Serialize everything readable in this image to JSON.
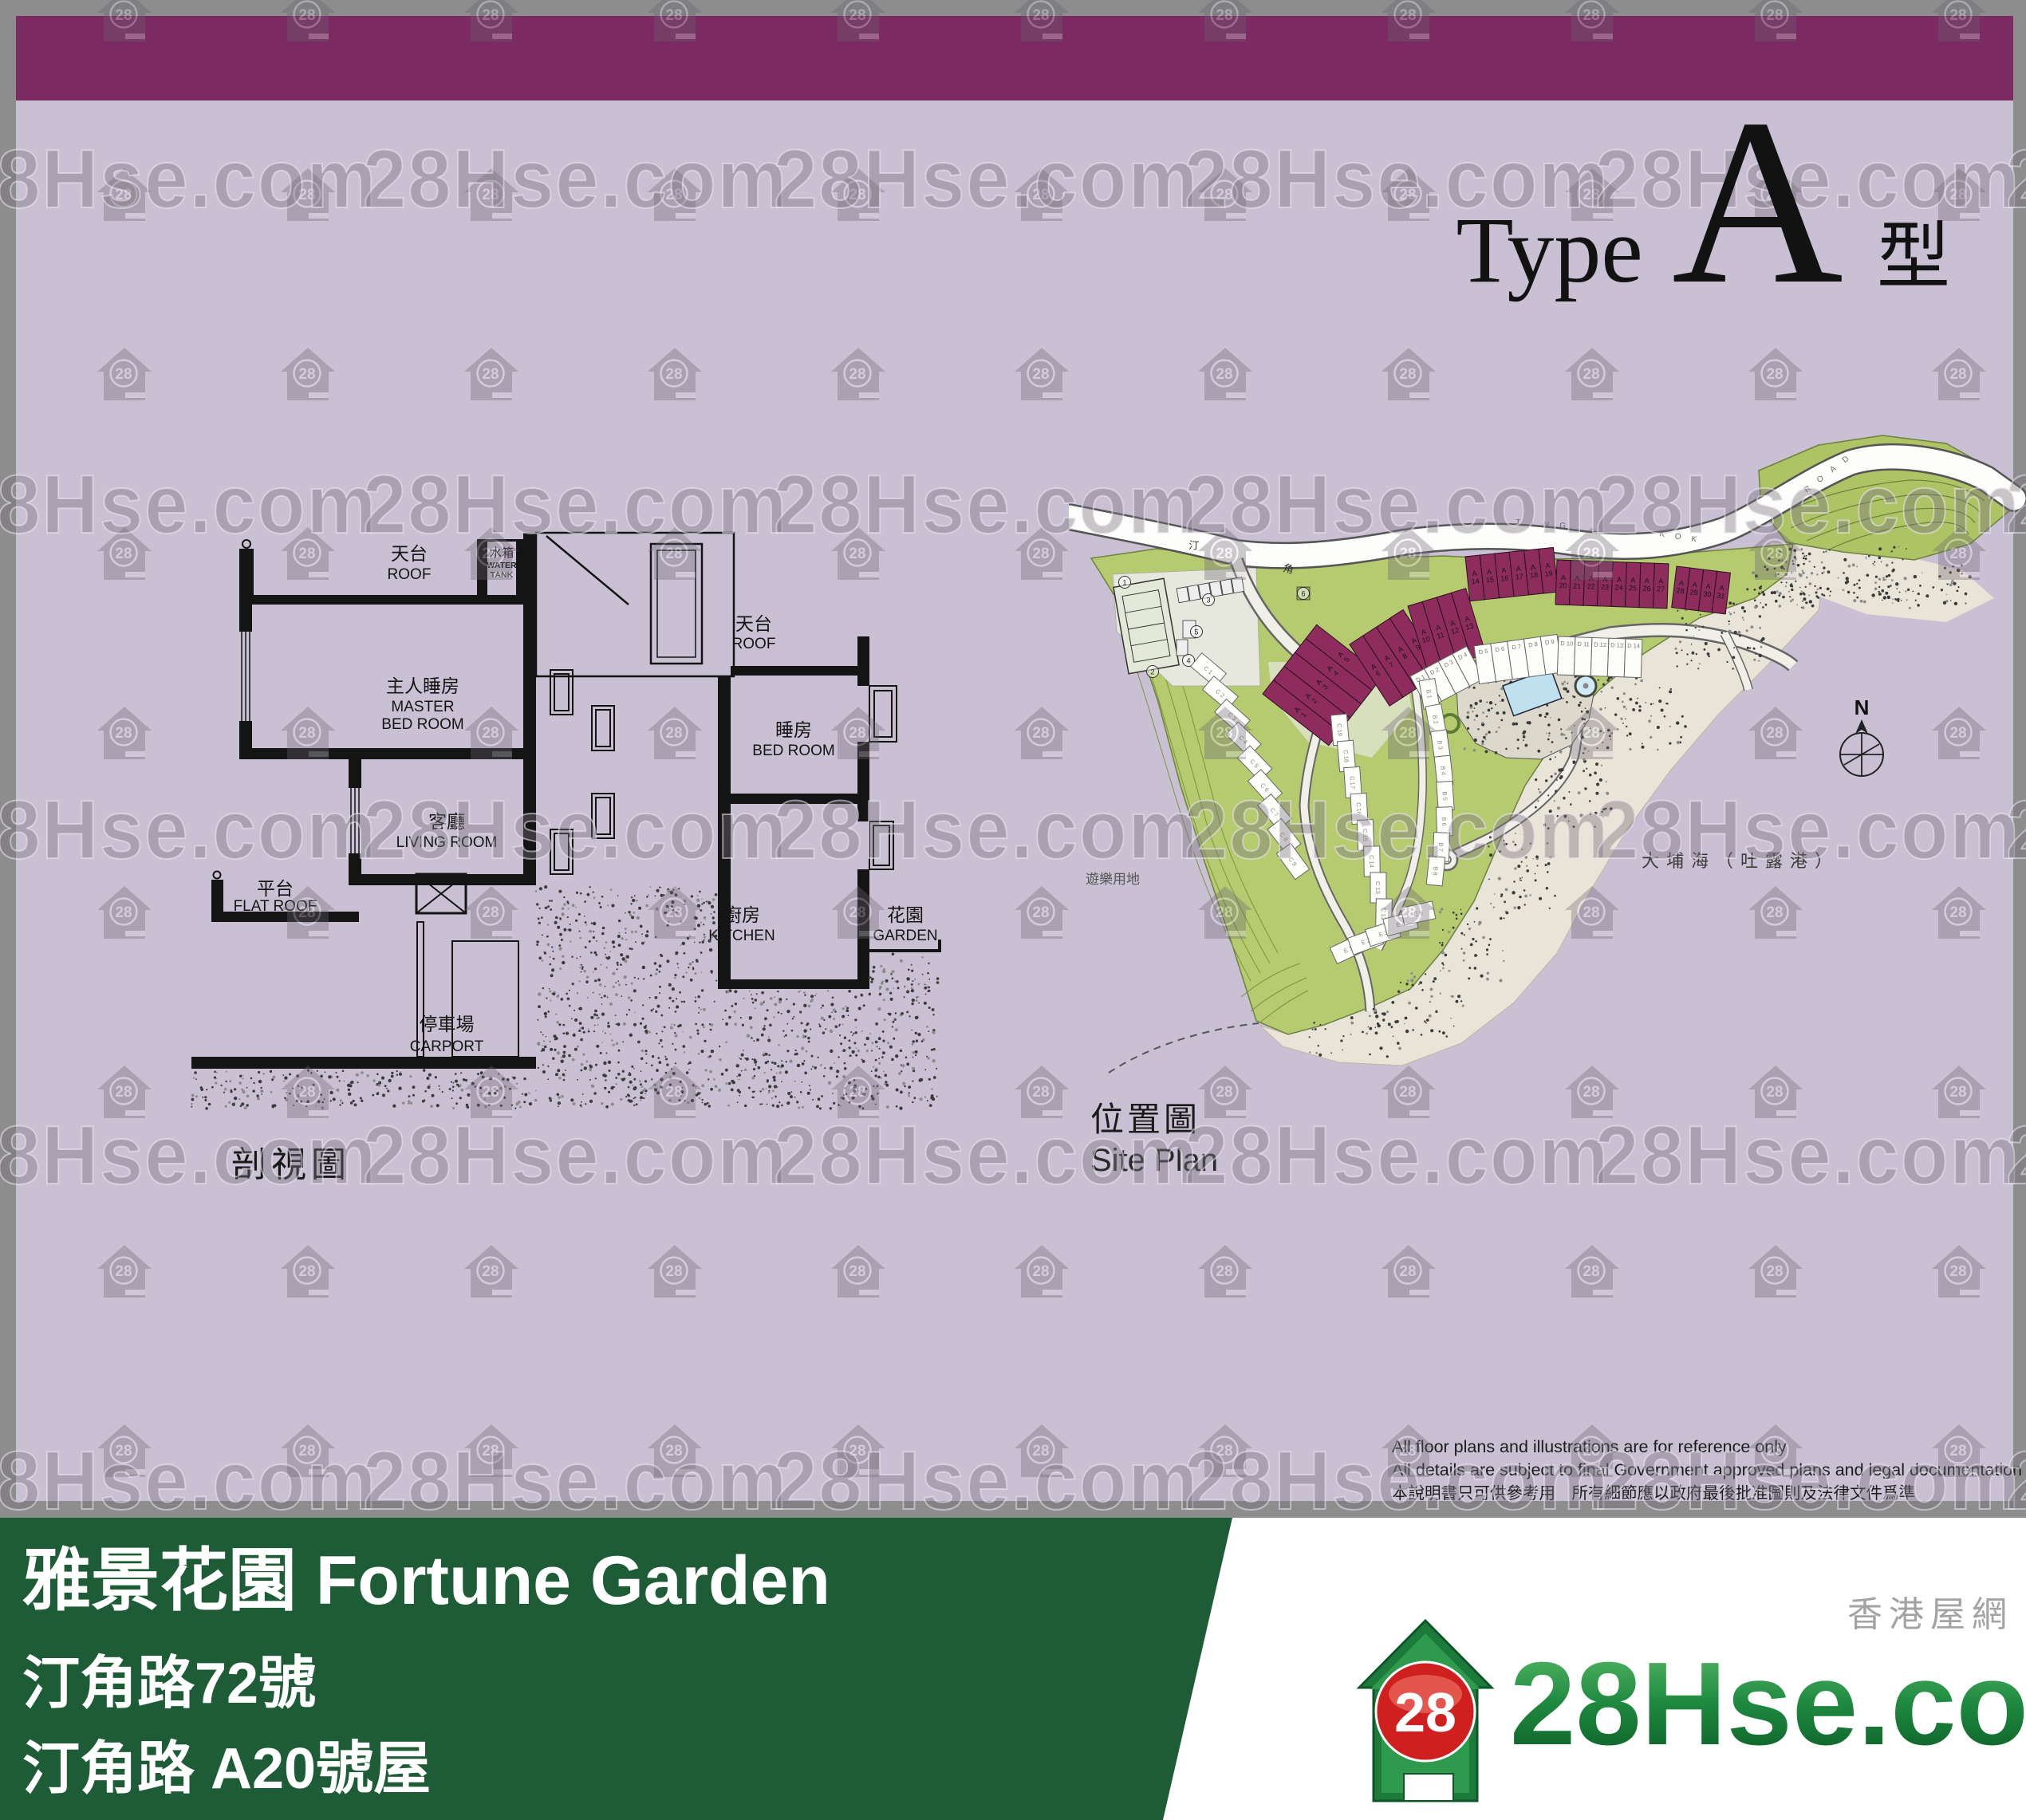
{
  "title": {
    "prefix": "Type",
    "letter": "A",
    "suffix": "型"
  },
  "watermark": {
    "text": "28Hse.com",
    "badge": "28"
  },
  "section": {
    "caption": "剖視圖",
    "labels": {
      "roof_l_cn": "天台",
      "roof_l_en": "ROOF",
      "tank_cn": "水箱",
      "tank_en1": "WATER",
      "tank_en2": "TANK",
      "master_cn": "主人睡房",
      "master_en1": "MASTER",
      "master_en2": "BED ROOM",
      "roof_r_cn": "天台",
      "roof_r_en": "ROOF",
      "bed_cn": "睡房",
      "bed_en": "BED ROOM",
      "living_cn": "客廳",
      "living_en": "LIVING ROOM",
      "flat_cn": "平台",
      "flat_en": "FLAT ROOF",
      "kitchen_cn": "廚房",
      "kitchen_en": "KITCHEN",
      "garden_cn": "花園",
      "garden_en": "GARDEN",
      "carport_cn": "停車場",
      "carport_en": "CARPORT"
    }
  },
  "siteplan": {
    "caption_cn": "位置圖",
    "caption_en": "Site Plan",
    "sea": "大埔海（吐露港）",
    "playground": "遊樂用地",
    "road": [
      "TING",
      "KOK",
      "ROAD"
    ],
    "street": [
      "汀",
      "角"
    ],
    "compass": "N",
    "court_markers": [
      "1",
      "2",
      "3",
      "4",
      "5",
      "6"
    ],
    "houses": {
      "a_groups": [
        [
          "A 1",
          "A 2",
          "A 3",
          "A 4",
          "A 5"
        ],
        [
          "A 6",
          "A 7",
          "A 8",
          "A 9"
        ],
        [
          "A 10",
          "A 11",
          "A 12",
          "A 13"
        ],
        [
          "A 14",
          "A 15",
          "A 16",
          "A 17",
          "A 18",
          "A 19"
        ],
        [
          "A 20",
          "A 21",
          "A 22",
          "A 23",
          "A 24",
          "A 25",
          "A 26",
          "A 27"
        ],
        [
          "A 28",
          "A 29",
          "A 30",
          "A 31"
        ]
      ],
      "b": [
        "B 1",
        "B 2",
        "B 3",
        "B 4",
        "B 5",
        "B 6",
        "B 7",
        "B 8"
      ],
      "c_left": [
        "C 1",
        "C 2",
        "C 3",
        "C 4",
        "C 5",
        "C 6",
        "C 7",
        "C 8",
        "C 9"
      ],
      "c_right": [
        "C 19",
        "C 18",
        "C 17",
        "C 16",
        "C 15",
        "C 14",
        "C 13",
        "C 12"
      ],
      "d": [
        "D 1",
        "D 2",
        "D 3",
        "D 4",
        "D 5",
        "D 6",
        "D 7",
        "D 8",
        "D 9",
        "D 10",
        "D 11",
        "D 12",
        "D 13",
        "D 14"
      ],
      "e": [
        "E 1",
        "E 2",
        "E 3",
        "E 4",
        "E 5"
      ]
    }
  },
  "disclaimer": {
    "line1": "All floor plans and illustrations are for reference only",
    "line2": "All details are subject to final Government approved plans and legal documentation",
    "line3": "本說明書只可供參考用　所有細節應以政府最後批准圖則及法律文件爲準"
  },
  "banner": {
    "title": "雅景花園 Fortune Garden",
    "line2": "汀角路72號",
    "line3": "汀角路 A20號屋"
  },
  "logo": {
    "badge": "28",
    "name": "28Hse.com",
    "tagline": "香港屋網"
  }
}
